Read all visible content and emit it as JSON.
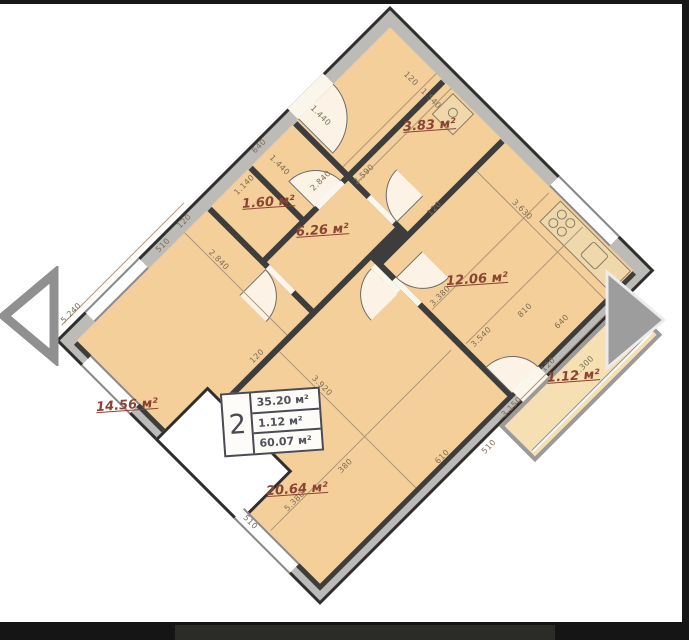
{
  "plan": {
    "rooms": [
      {
        "name": "bathroom",
        "area": "3.83 м²"
      },
      {
        "name": "wc",
        "area": "1.60 м²"
      },
      {
        "name": "hallway",
        "area": "6.26 м²"
      },
      {
        "name": "kitchen",
        "area": "12.06 м²"
      },
      {
        "name": "bedroom",
        "area": "14.56 м²"
      },
      {
        "name": "balcony",
        "area": "1.12 м²"
      },
      {
        "name": "living-room",
        "area": "20.64 м²"
      }
    ],
    "legend": {
      "rooms_count": "2",
      "rows": [
        "35.20 м²",
        "1.12 м²",
        "60.07 м²"
      ]
    },
    "dims": [
      "5.240",
      "640",
      "1.440",
      "120",
      "510",
      "2.840",
      "2.840",
      "1.440",
      "1.140",
      "120",
      "1.540",
      "2.590",
      "120",
      "3.630",
      "640",
      "810",
      "3.380",
      "3.540",
      "120",
      "3.920",
      "5.380",
      "510",
      "610",
      "380",
      "120",
      "3.150",
      "1.300",
      "510"
    ],
    "colors": {
      "floor": "#f4cf9a",
      "wall_fill": "#bdbbb7",
      "wall_line": "#2f2f2f",
      "area_label": "#8a4433",
      "dim_text": "#7d6c54",
      "legend_text": "#4a4b52"
    }
  }
}
